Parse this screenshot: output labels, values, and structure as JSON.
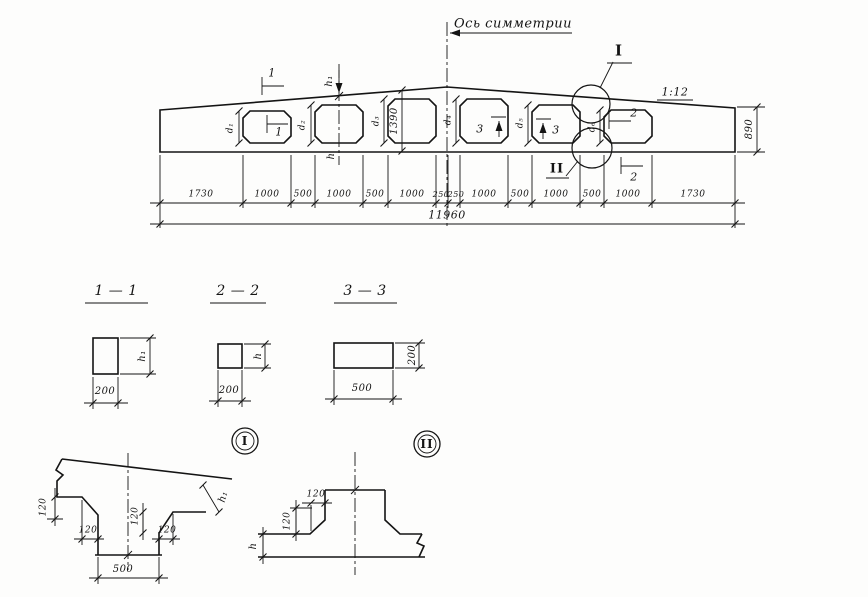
{
  "elevation": {
    "axis_label": "Ось симметрии",
    "slope": "1:12",
    "total": "11960",
    "end_height": "890",
    "mid_height": "1390",
    "h1": "h₁",
    "h": "h",
    "cut1": "1",
    "cut2": "2",
    "cut3": "3",
    "detail1": "I",
    "detail2": "II",
    "hole_dims": [
      "d₁",
      "d₂",
      "d₃",
      "d₄",
      "d₅",
      "d₆"
    ],
    "seg_labels": [
      "1730",
      "1000",
      "500",
      "1000",
      "500",
      "1000",
      "250",
      "250",
      "1000",
      "500",
      "1000",
      "500",
      "1000",
      "1730"
    ]
  },
  "sections": {
    "s11": {
      "title": "1 — 1",
      "width": "200",
      "height": "h₁"
    },
    "s22": {
      "title": "2 — 2",
      "width": "200",
      "height": "h"
    },
    "s33": {
      "title": "3 — 3",
      "width": "500",
      "height": "200"
    }
  },
  "details": {
    "d1": {
      "badge": "I",
      "v120": "120",
      "h120a": "120",
      "v120b": "120",
      "h120b": "120",
      "post_width": "500",
      "height": "h₁"
    },
    "d2": {
      "badge": "II",
      "h120": "120",
      "v120": "120",
      "height": "h"
    }
  }
}
